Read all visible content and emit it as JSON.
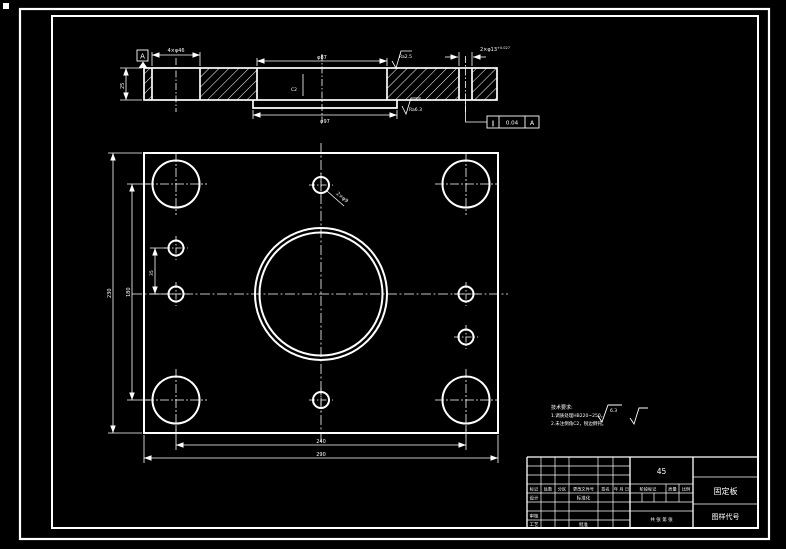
{
  "colors": {
    "background": "#000000",
    "line": "#ffffff"
  },
  "section": {
    "hole_dim": "4×φ46",
    "datum_label": "A",
    "thickness_dim": "25",
    "bore_dim": "φ87",
    "boss_dim": "φ97",
    "chamfer_label": "C2",
    "surface_top": "Ra2.5",
    "surface_bottom": "Ra6.3",
    "pin_dim": "2×φ13",
    "pin_tol": "+0.027",
    "fcf_symbol": "∥",
    "fcf_value": "0.04",
    "fcf_datum": "A"
  },
  "plan": {
    "top_hole_label": "2×φ9",
    "width_inner": "240",
    "width_outer": "290",
    "height_outer": "230",
    "height_inner": "180",
    "small_spacing": "35"
  },
  "notes": {
    "title": "技术要求:",
    "line1": "1.调质处理HB220~250。",
    "line2": "2.未注倒角C2，锐边倒钝。",
    "finish_value": "6.3"
  },
  "titleblock": {
    "material": "45",
    "part_name": "固定板",
    "drawing_code": "图样代号",
    "rev_headers": [
      "标记",
      "处数",
      "分区",
      "更改文件号",
      "签名",
      "年 月 日"
    ],
    "design": "设计",
    "standardize": "标准化",
    "check": "审核",
    "process": "工艺",
    "approve": "批准",
    "stage_mark": "阶段标记",
    "weight": "质量",
    "scale": "比例",
    "sheet": "共 张 第 张"
  }
}
